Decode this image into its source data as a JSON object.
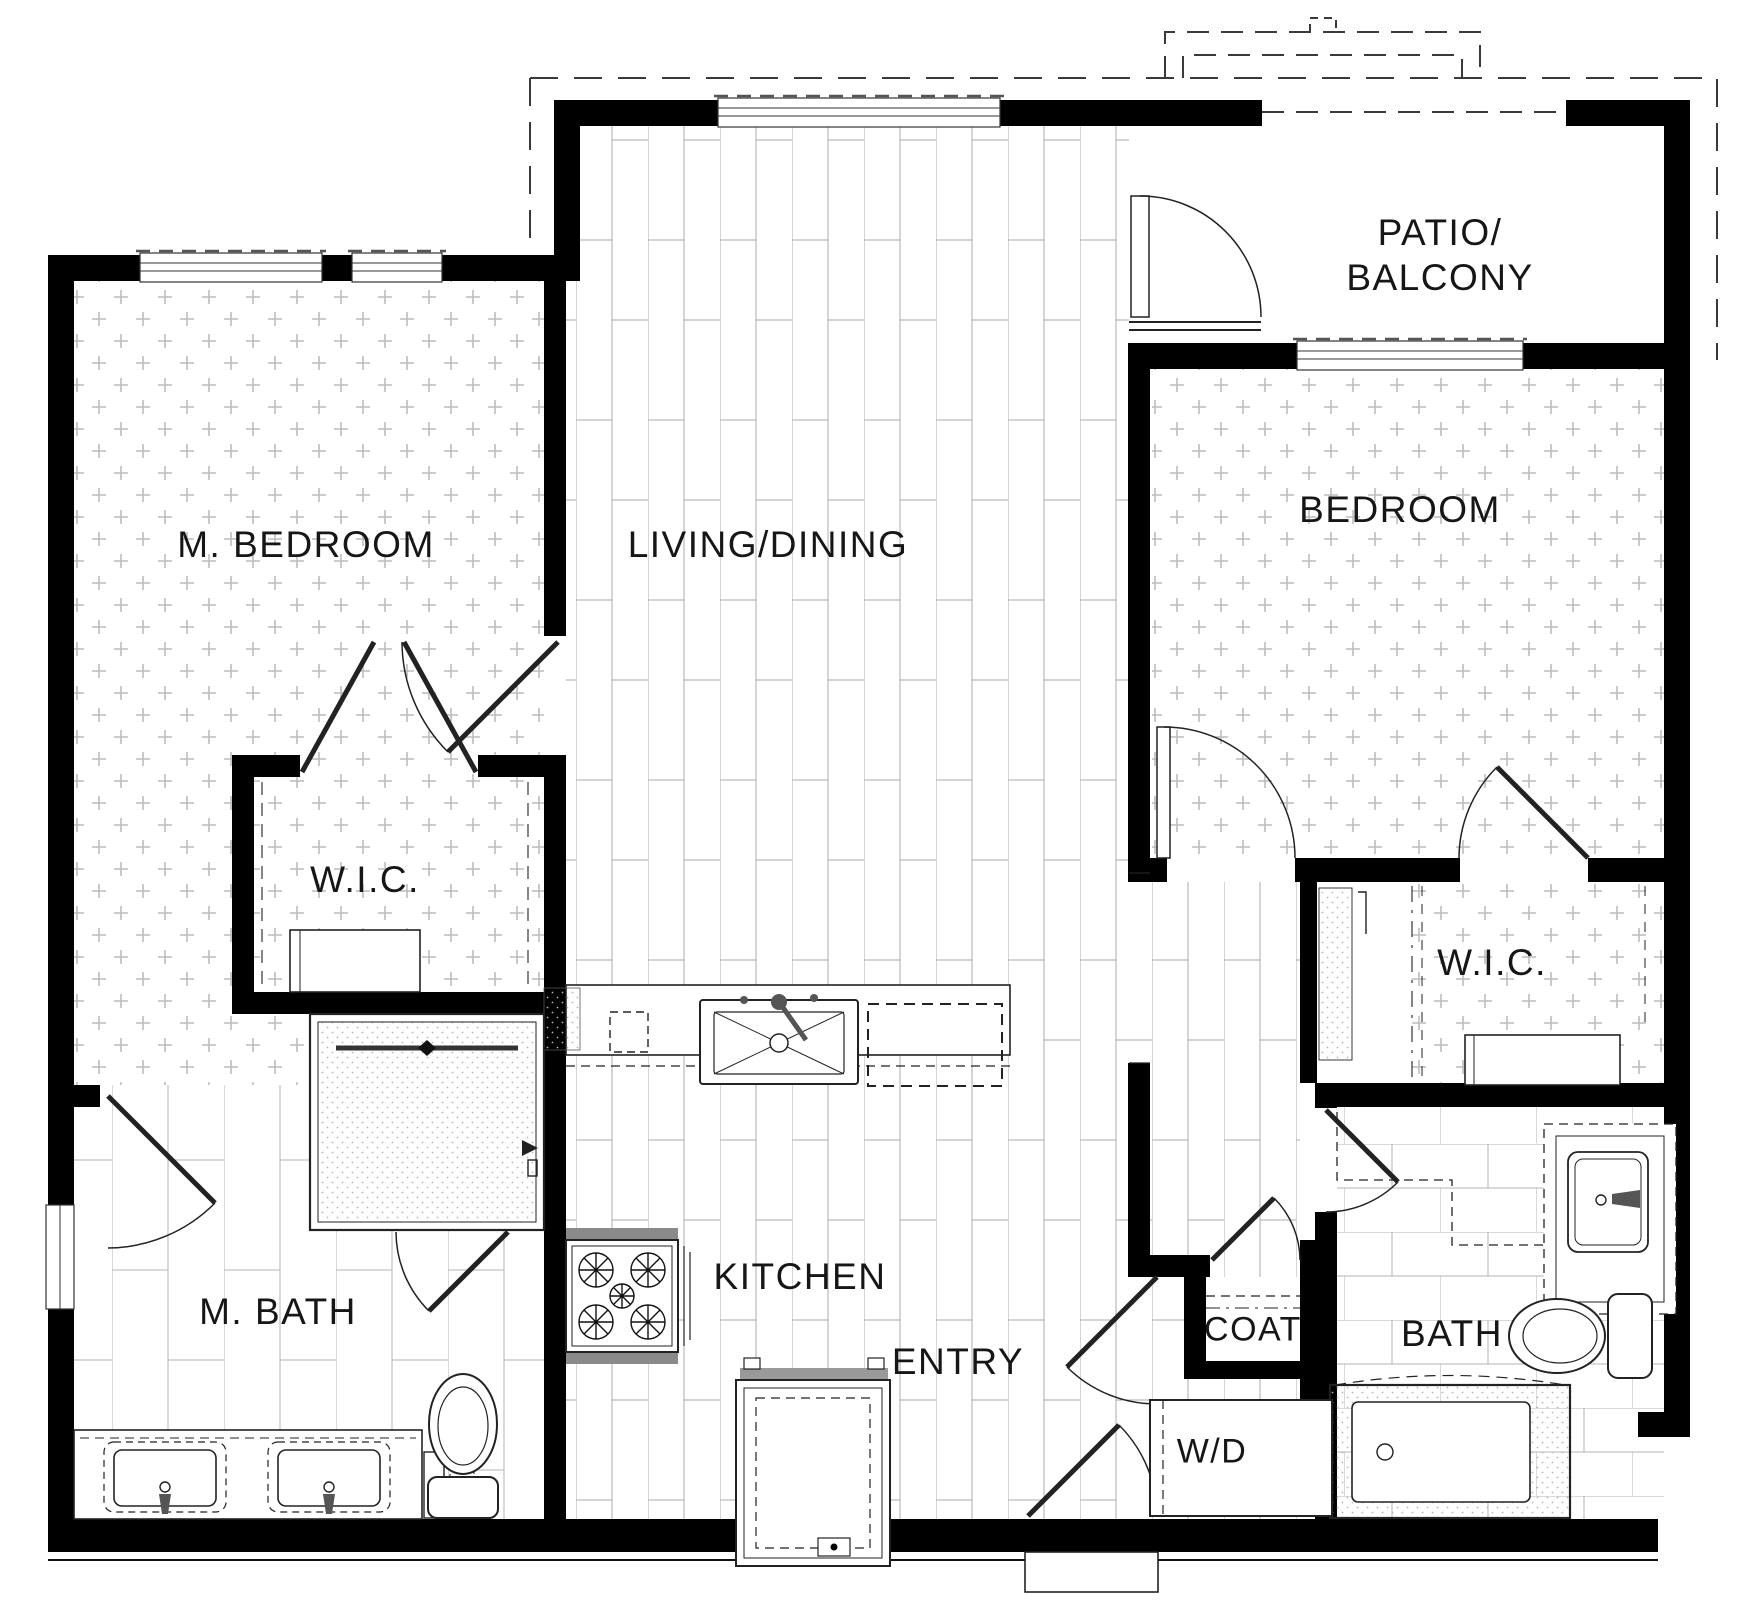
{
  "plan": {
    "type": "apartment-floor-plan",
    "units": "2 bedroom / 2 bath",
    "colors": {
      "wall": "#000000",
      "line": "#222222",
      "hatch_carpet": "#b8b8b8",
      "hatch_plank": "#a8a8a8",
      "hatch_tile": "#b0b0b0",
      "background": "#ffffff",
      "text": "#161616"
    }
  },
  "labels": {
    "m_bedroom": {
      "text": "M. BEDROOM"
    },
    "living_dining": {
      "text": "LIVING/DINING"
    },
    "patio_line1": {
      "text": "PATIO/"
    },
    "patio_line2": {
      "text": "BALCONY"
    },
    "bedroom": {
      "text": "BEDROOM"
    },
    "wic_master": {
      "text": "W.I.C."
    },
    "wic_bedroom": {
      "text": "W.I.C."
    },
    "kitchen": {
      "text": "KITCHEN"
    },
    "m_bath": {
      "text": "M. BATH"
    },
    "entry": {
      "text": "ENTRY"
    },
    "coat": {
      "text": "COAT"
    },
    "bath": {
      "text": "BATH"
    },
    "washer_dryer": {
      "text": "W/D"
    }
  },
  "rooms": [
    {
      "name": "M. BEDROOM",
      "floor": "carpet"
    },
    {
      "name": "LIVING/DINING",
      "floor": "plank"
    },
    {
      "name": "PATIO/BALCONY",
      "floor": "bare"
    },
    {
      "name": "BEDROOM",
      "floor": "carpet"
    },
    {
      "name": "W.I.C. (master)",
      "floor": "carpet"
    },
    {
      "name": "W.I.C. (bedroom)",
      "floor": "carpet"
    },
    {
      "name": "KITCHEN",
      "floor": "plank"
    },
    {
      "name": "M. BATH",
      "floor": "tile"
    },
    {
      "name": "BATH",
      "floor": "tile"
    },
    {
      "name": "ENTRY",
      "floor": "plank"
    },
    {
      "name": "COAT",
      "floor": "bare"
    },
    {
      "name": "W/D",
      "floor": "bare"
    }
  ],
  "fixtures": [
    "kitchen-sink",
    "dishwasher",
    "stove",
    "refrigerator",
    "pantry",
    "shower",
    "master-vanity-sink-left",
    "master-vanity-sink-right",
    "master-toilet",
    "bath-vanity-sink",
    "bath-toilet",
    "bathtub",
    "washer-dryer",
    "linen-shelves",
    "wic-dresser-master",
    "wic-dresser-bedroom"
  ]
}
